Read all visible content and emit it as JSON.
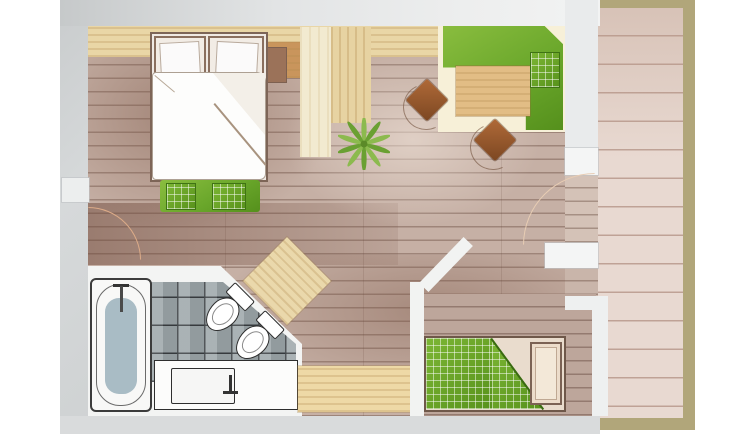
{
  "scene": {
    "title": "apartment-floor-plan",
    "style": "watercolor-architectural-top-view"
  },
  "rooms": [
    {
      "name": "main-living-sleeping-area"
    },
    {
      "name": "seating-corner"
    },
    {
      "name": "bathroom"
    },
    {
      "name": "single-bedroom"
    },
    {
      "name": "balcony-strip"
    }
  ],
  "furniture": [
    "double-bed",
    "bed-pillows",
    "foot-bench",
    "plaid-cushions",
    "nightstand",
    "corner-sofa",
    "sofa-cushion",
    "coffee-table",
    "chair",
    "chair",
    "plant",
    "ceiling-beams",
    "bathtub",
    "toilet",
    "bidet",
    "sink-vanity",
    "corner-cabinet",
    "sideboard",
    "single-bed",
    "doors-with-swing-arcs"
  ],
  "colors": {
    "wall_grey": "#d3d6d7",
    "wall_white": "#f2f3f2",
    "floor_base": "#c6b0a5",
    "floor_dark": "#a5897c",
    "floor_light": "#d9c9bf",
    "plank_line": "#5c3e32",
    "beam_wood": "#e9d6a6",
    "beam_cream": "#f2ead0",
    "sofa_green": "#76ad33",
    "plaid_green": "#69a528",
    "chair_brown": "#a85f30",
    "table_wood": "#e2bd85",
    "balcony_floor": "#e8d9d1",
    "balcony_border": "#b1a67a",
    "tile_grey": "#9ea8ab",
    "tile_line": "#3e4346",
    "tub_mat": "#a9bcc5",
    "fixture_outline": "#2e2e2e",
    "cabinet_tan": "#ead8ab",
    "bed_frame_brown": "#6d5547",
    "door_arc": "#dcab88"
  }
}
